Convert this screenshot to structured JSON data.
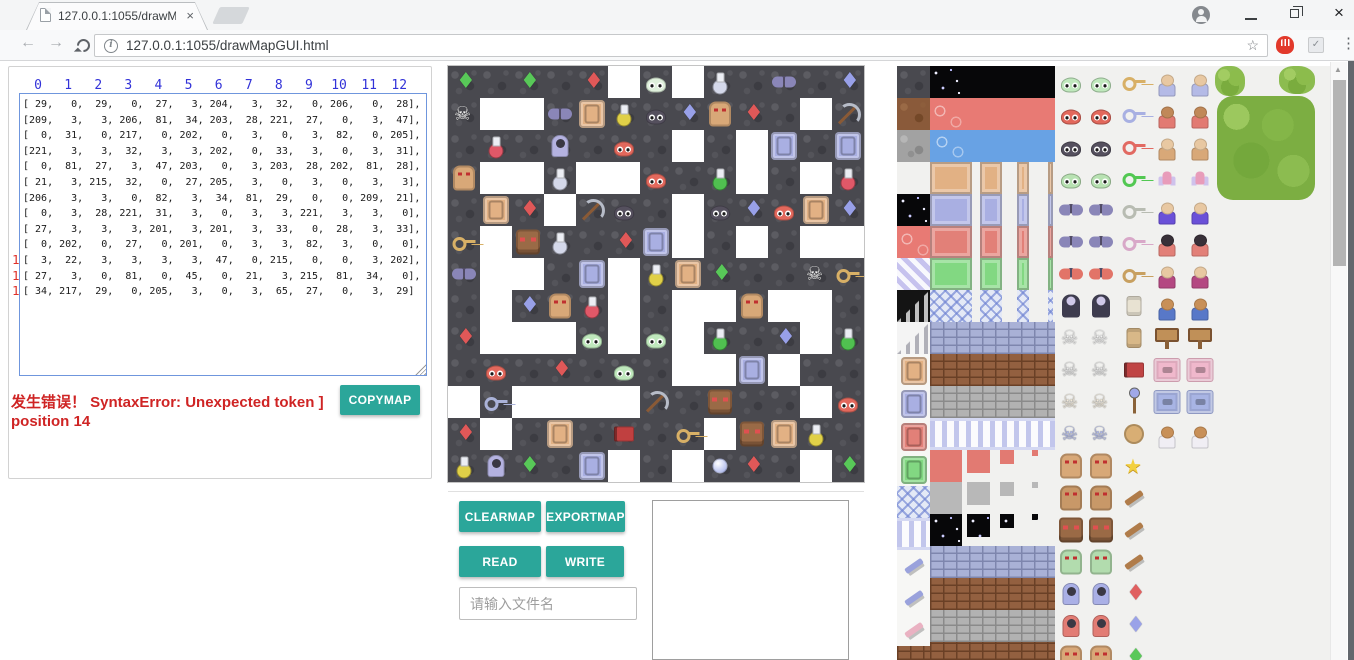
{
  "browser": {
    "tab_title": "127.0.0.1:1055/drawMa",
    "tab_close": "×",
    "url": "127.0.0.1:1055/drawMapGUI.html",
    "star_icon": "☆",
    "menu_dots": "⋮",
    "check_ext": "✓",
    "window_close": "×",
    "scroll_up_arrow": "▲"
  },
  "colors": {
    "accent": "#2ba69a",
    "error": "#cf2424",
    "col_header": "#3232d8",
    "row_header": "#e03028"
  },
  "left_panel": {
    "col_headers": [
      "0",
      "1",
      "2",
      "3",
      "4",
      "5",
      "6",
      "7",
      "8",
      "9",
      "10",
      "11",
      "12"
    ],
    "row_headers": [
      "0",
      "1",
      "2",
      "3",
      "4",
      "5",
      "6",
      "7",
      "8",
      "9",
      "10",
      "11",
      "12"
    ]
  },
  "error": {
    "line1": "发生错误！ SyntaxError: Unexpected token ]",
    "line2": "position 14"
  },
  "buttons": {
    "copymap": "COPYMAP",
    "clearmap": "CLEARMAP",
    "exportmap": "EXPORTMAP",
    "read": "READ",
    "write": "WRITE"
  },
  "file_input": {
    "placeholder": "请输入文件名"
  },
  "map": {
    "tile_size": 32,
    "matrix": [
      [
        29,
        0,
        29,
        0,
        27,
        3,
        204,
        3,
        32,
        0,
        206,
        0,
        28
      ],
      [
        209,
        3,
        3,
        206,
        81,
        34,
        203,
        28,
        221,
        27,
        0,
        3,
        47
      ],
      [
        0,
        31,
        0,
        217,
        0,
        202,
        0,
        3,
        0,
        3,
        82,
        0,
        205
      ],
      [
        221,
        3,
        3,
        32,
        3,
        3,
        202,
        0,
        33,
        3,
        0,
        3,
        31
      ],
      [
        0,
        81,
        27,
        3,
        47,
        203,
        0,
        3,
        203,
        28,
        202,
        81,
        28
      ],
      [
        21,
        3,
        215,
        32,
        0,
        27,
        205,
        3,
        0,
        3,
        0,
        3,
        3
      ],
      [
        206,
        3,
        3,
        0,
        82,
        3,
        34,
        81,
        29,
        0,
        0,
        209,
        21
      ],
      [
        0,
        3,
        28,
        221,
        31,
        3,
        0,
        3,
        3,
        221,
        3,
        3,
        0
      ],
      [
        27,
        3,
        3,
        3,
        201,
        3,
        201,
        3,
        33,
        0,
        28,
        3,
        33
      ],
      [
        0,
        202,
        0,
        27,
        0,
        201,
        0,
        3,
        3,
        82,
        3,
        0,
        0
      ],
      [
        3,
        22,
        3,
        3,
        3,
        3,
        47,
        0,
        215,
        0,
        0,
        3,
        202
      ],
      [
        27,
        3,
        0,
        81,
        0,
        45,
        0,
        21,
        3,
        215,
        81,
        34,
        0
      ],
      [
        34,
        217,
        29,
        0,
        205,
        3,
        0,
        3,
        65,
        27,
        0,
        3,
        29
      ]
    ],
    "legend": {
      "0": {
        "k": "floor"
      },
      "3": {
        "k": "wall"
      },
      "21": {
        "k": "key",
        "c": "#d8b066"
      },
      "22": {
        "k": "key",
        "c": "#aab2d8"
      },
      "27": {
        "k": "gem",
        "c": "#e05858"
      },
      "28": {
        "k": "gem",
        "c": "#98a0e8"
      },
      "29": {
        "k": "gem",
        "c": "#58c858"
      },
      "31": {
        "k": "potion",
        "c": "#e05868"
      },
      "32": {
        "k": "potion",
        "c": "#d4d8ea"
      },
      "33": {
        "k": "potion",
        "c": "#50c050"
      },
      "34": {
        "k": "potion",
        "c": "#e0d048"
      },
      "45": {
        "k": "book",
        "c": "#c04040"
      },
      "47": {
        "k": "pickaxe"
      },
      "65": {
        "k": "orb"
      },
      "81": {
        "k": "door",
        "c": "#e2b184"
      },
      "82": {
        "k": "door",
        "c": "#a9afe2"
      },
      "201": {
        "k": "slime",
        "c": "#bfe8bc"
      },
      "202": {
        "k": "slime",
        "c": "#e2685c"
      },
      "203": {
        "k": "slime",
        "c": "#55505e"
      },
      "204": {
        "k": "slime",
        "c": "#dff0dc"
      },
      "205": {
        "k": "door",
        "c": "#a9afe2"
      },
      "206": {
        "k": "bat"
      },
      "209": {
        "k": "skel"
      },
      "215": {
        "k": "face"
      },
      "217": {
        "k": "ghost"
      },
      "221": {
        "k": "golem"
      }
    }
  },
  "palette": {
    "left_col": [
      "rock_dark",
      "rock_brown",
      "rock_gray",
      "brick_light",
      "starfield",
      "pink",
      "stripes",
      "stairs_dark",
      "stairs_light",
      "door:#e2b184",
      "door:#a9afe2",
      "door:#e28078",
      "door:#82d882",
      "lattice",
      "pillars",
      "wing:#9aa2dc",
      "wing:#9aa2dc",
      "wing:#eab2c2",
      "brick_brown"
    ],
    "band_rows": [
      {
        "y": 0,
        "segs": [
          [
            33,
            125
          ]
        ],
        "bg": "starfield"
      },
      {
        "y": 32,
        "segs": [
          [
            33,
            125
          ]
        ],
        "bg": "pink"
      },
      {
        "y": 64,
        "segs": [
          [
            33,
            125
          ]
        ],
        "bg": "water"
      },
      {
        "y": 96,
        "segs": [
          [
            33,
            42
          ],
          [
            83,
            22
          ],
          [
            120,
            12
          ],
          [
            151,
            5
          ]
        ],
        "bg": "doorband",
        "c": "#e2b184"
      },
      {
        "y": 128,
        "segs": [
          [
            33,
            42
          ],
          [
            83,
            22
          ],
          [
            120,
            12
          ],
          [
            151,
            5
          ]
        ],
        "bg": "doorband",
        "c": "#a9afe2"
      },
      {
        "y": 160,
        "segs": [
          [
            33,
            42
          ],
          [
            83,
            22
          ],
          [
            120,
            12
          ],
          [
            151,
            5
          ]
        ],
        "bg": "doorband",
        "c": "#e28078"
      },
      {
        "y": 192,
        "segs": [
          [
            33,
            42
          ],
          [
            83,
            22
          ],
          [
            120,
            12
          ],
          [
            151,
            5
          ]
        ],
        "bg": "doorband",
        "c": "#82d882"
      },
      {
        "y": 224,
        "segs": [
          [
            33,
            42
          ],
          [
            83,
            22
          ],
          [
            120,
            12
          ],
          [
            151,
            5
          ]
        ],
        "bg": "lattice"
      },
      {
        "y": 256,
        "segs": [
          [
            33,
            125
          ]
        ],
        "bg": "brick_blue"
      },
      {
        "y": 288,
        "segs": [
          [
            33,
            125
          ]
        ],
        "bg": "brick_brown"
      },
      {
        "y": 320,
        "segs": [
          [
            33,
            125
          ]
        ],
        "bg": "brick_gray"
      },
      {
        "y": 352,
        "segs": [
          [
            33,
            125
          ]
        ],
        "bg": "pillars"
      },
      {
        "y": 384,
        "segs": [
          [
            33,
            32
          ],
          [
            70,
            23
          ],
          [
            103,
            14
          ],
          [
            135,
            6
          ]
        ],
        "bg": "sq",
        "c": "#e27a72"
      },
      {
        "y": 416,
        "segs": [
          [
            33,
            32
          ],
          [
            70,
            23
          ],
          [
            103,
            14
          ],
          [
            135,
            6
          ]
        ],
        "bg": "sq",
        "c": "#b8b8b8"
      },
      {
        "y": 448,
        "segs": [
          [
            33,
            32
          ],
          [
            70,
            23
          ],
          [
            103,
            14
          ],
          [
            135,
            6
          ]
        ],
        "bg": "starfield"
      },
      {
        "y": 480,
        "segs": [
          [
            33,
            125
          ]
        ],
        "bg": "brick_blue"
      },
      {
        "y": 512,
        "segs": [
          [
            33,
            125
          ]
        ],
        "bg": "brick_brown"
      },
      {
        "y": 544,
        "segs": [
          [
            33,
            125
          ]
        ],
        "bg": "brick_gray"
      },
      {
        "y": 576,
        "segs": [
          [
            33,
            125
          ]
        ],
        "bg": "brick_brown"
      }
    ],
    "monster_pairs": [
      {
        "kind": "slime",
        "c": "#bfe8bc"
      },
      {
        "kind": "slime",
        "c": "#e2685c"
      },
      {
        "kind": "slime",
        "c": "#55505e"
      },
      {
        "kind": "slime",
        "c": "#b8e2b2"
      },
      {
        "kind": "bat",
        "c": "#8a86b8"
      },
      {
        "kind": "bat",
        "c": "#8a86b8"
      },
      {
        "kind": "bat",
        "c": "#e27468"
      },
      {
        "kind": "vamp",
        "c": ""
      },
      {
        "kind": "skel",
        "c": "#f2f2f2"
      },
      {
        "kind": "skel",
        "c": "#e8e8e8"
      },
      {
        "kind": "skel",
        "c": "#f0e8d8"
      },
      {
        "kind": "skel",
        "c": "#aab4e8"
      },
      {
        "kind": "golem",
        "c": "#d8a878"
      },
      {
        "kind": "golem",
        "c": "#c89868"
      },
      {
        "kind": "face",
        "c": "#9a6a46"
      },
      {
        "kind": "golem",
        "c": "#b2dcae"
      },
      {
        "kind": "ghost",
        "c": "#aab0e6"
      },
      {
        "kind": "ghost",
        "c": "#e27c74"
      },
      {
        "kind": "golem",
        "c": "#d8a878"
      }
    ],
    "items": [
      {
        "kind": "key",
        "c": "#d8b066"
      },
      {
        "kind": "key",
        "c": "#a8b0e2"
      },
      {
        "kind": "key",
        "c": "#e26a62"
      },
      {
        "kind": "key",
        "c": "#52c852"
      },
      {
        "kind": "key",
        "c": "#b8bcb2"
      },
      {
        "kind": "key",
        "c": "#d8a8c8"
      },
      {
        "kind": "key",
        "c": "#c8a060"
      },
      {
        "kind": "scroll",
        "c": "#e8e2d2"
      },
      {
        "kind": "scroll",
        "c": "#d8b888"
      },
      {
        "kind": "book",
        "c": "#c04444"
      },
      {
        "kind": "staff",
        "c": ""
      },
      {
        "kind": "coin",
        "c": ""
      },
      {
        "kind": "star",
        "c": ""
      },
      {
        "kind": "wing",
        "c": "#b07c4a"
      },
      {
        "kind": "wing",
        "c": "#b07c4a"
      },
      {
        "kind": "wing",
        "c": "#b07c4a"
      },
      {
        "kind": "gem",
        "c": "#e06060"
      },
      {
        "kind": "gem",
        "c": "#9aa2e8"
      },
      {
        "kind": "gem",
        "c": "#5ac85a"
      }
    ],
    "char_pairs": [
      {
        "kind": "person",
        "b": "#b4bae6",
        "h": "#e8c8a2"
      },
      {
        "kind": "person",
        "b": "#e27a72",
        "h": "#c08858"
      },
      {
        "kind": "person",
        "b": "#d8a878",
        "h": "#e8c8a2"
      },
      {
        "kind": "fairy",
        "b": "",
        "h": ""
      },
      {
        "kind": "person",
        "b": "#6a50d8",
        "h": "#e8c8a2"
      },
      {
        "kind": "person",
        "b": "#e28078",
        "h": "#383038"
      },
      {
        "kind": "person",
        "b": "#b44882",
        "h": "#e8c8a2"
      },
      {
        "kind": "person",
        "b": "#5878c8",
        "h": "#c89058"
      },
      {
        "kind": "sign",
        "b": "",
        "h": ""
      },
      {
        "kind": "wallseg",
        "b": "#f0b8cc",
        "h": ""
      },
      {
        "kind": "wallseg",
        "b": "#a8b4e4",
        "h": ""
      },
      {
        "kind": "person",
        "b": "#f0eef4",
        "h": "#c89058"
      }
    ],
    "trees": [
      {
        "x": 318,
        "y": 0,
        "w": 30,
        "h": 30,
        "kind": "bush"
      },
      {
        "x": 382,
        "y": 0,
        "w": 36,
        "h": 28,
        "kind": "bush"
      },
      {
        "x": 320,
        "y": 30,
        "w": 98,
        "h": 104,
        "kind": "tree"
      }
    ]
  }
}
